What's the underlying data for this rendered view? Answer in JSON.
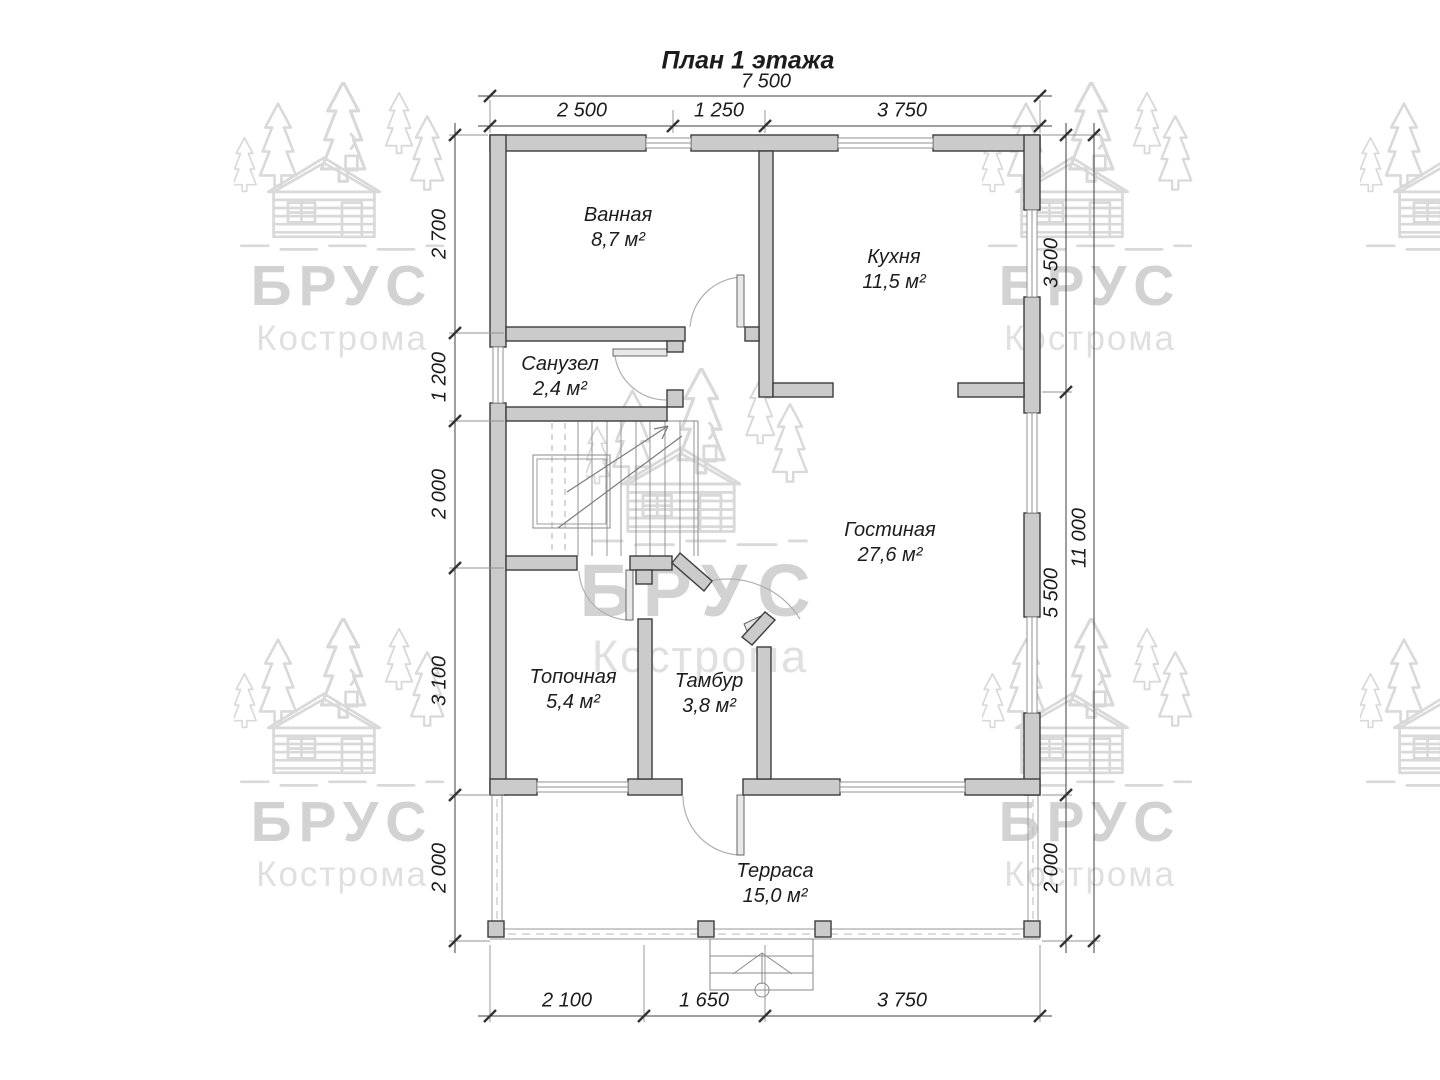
{
  "title": "План 1 этажа",
  "dims": {
    "top_total": "7 500",
    "top_segments": [
      "2 500",
      "1 250",
      "3 750"
    ],
    "bottom_segments": [
      "2 100",
      "1 650",
      "3 750"
    ],
    "left_segments": [
      "2 700",
      "1 200",
      "2 000",
      "3 100",
      "2 000"
    ],
    "right_segments": [
      "3 500",
      "5 500",
      "2 000"
    ],
    "right_total": "11 000"
  },
  "rooms": [
    {
      "name": "Ванная",
      "area": "8,7 м²"
    },
    {
      "name": "Кухня",
      "area": "11,5 м²"
    },
    {
      "name": "Санузел",
      "area": "2,4 м²"
    },
    {
      "name": "Гостиная",
      "area": "27,6 м²"
    },
    {
      "name": "Топочная",
      "area": "5,4 м²"
    },
    {
      "name": "Тамбур",
      "area": "3,8 м²"
    },
    {
      "name": "Терраса",
      "area": "15,0 м²"
    }
  ],
  "watermark": {
    "brand": "БРУС",
    "city": "Кострома"
  },
  "colors": {
    "wall_fill": "#cbcbcb",
    "wall_stroke": "#3c3c3c",
    "thin_line": "#8a8a8a",
    "dim_line": "#3f3f3f",
    "watermark_gray": "#d9d9d9"
  }
}
